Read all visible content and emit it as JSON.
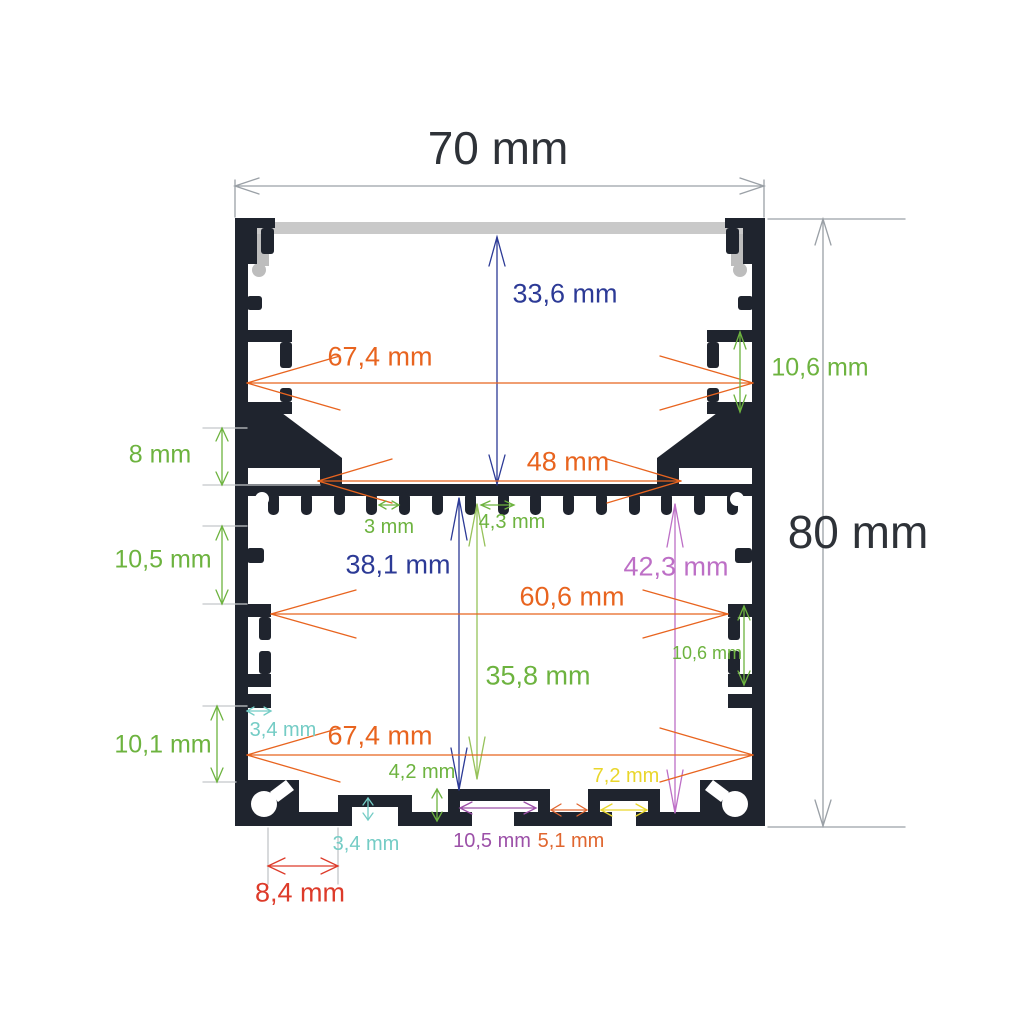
{
  "colors": {
    "profile": "#1f242e",
    "diffuser": "#c9c9c9",
    "diffuser_clip": "#bdbdbd",
    "dim_dark": "#2e3238",
    "orange": "#e8641f",
    "blue": "#2c3a96",
    "green": "#6db33f",
    "green_light": "#96c25a",
    "purple": "#bd6fc6",
    "purple_dark": "#9c50a8",
    "teal": "#74ccc5",
    "yellow": "#e9d62b",
    "red": "#dd3b2a",
    "orange_red": "#e0662f",
    "gray_line": "#9aa0a6",
    "gray_ext": "#c4c6c9"
  },
  "dimensions": {
    "overall_width": "70 mm",
    "overall_height": "80 mm",
    "top_cavity_depth": "33,6 mm",
    "upper_inner_width": "67,4 mm",
    "upper_pocket_height": "10,6 mm",
    "gusset_height": "8 mm",
    "led_shelf_opening": "48 mm",
    "fin_gap": "3 mm",
    "fin_pitch": "4,3 mm",
    "upper_wall_segment": "10,5 mm",
    "shelf_to_channel_depth": "38,1 mm",
    "shelf_to_base_depth": "42,3 mm",
    "lower_inner_width": "60,6 mm",
    "lower_pocket_height": "10,6 mm",
    "lower_cavity_depth": "35,8 mm",
    "lower_wall_segment": "10,1 mm",
    "wall_step_width": "3,4 mm",
    "lower_full_inner_width": "67,4 mm",
    "channel_height": "4,2 mm",
    "channel_width_yellow": "7,2 mm",
    "base_step_height": "3,4 mm",
    "channel_width_purple": "10,5 mm",
    "channel_gap": "5,1 mm",
    "corner_boss_offset": "8,4 mm"
  }
}
